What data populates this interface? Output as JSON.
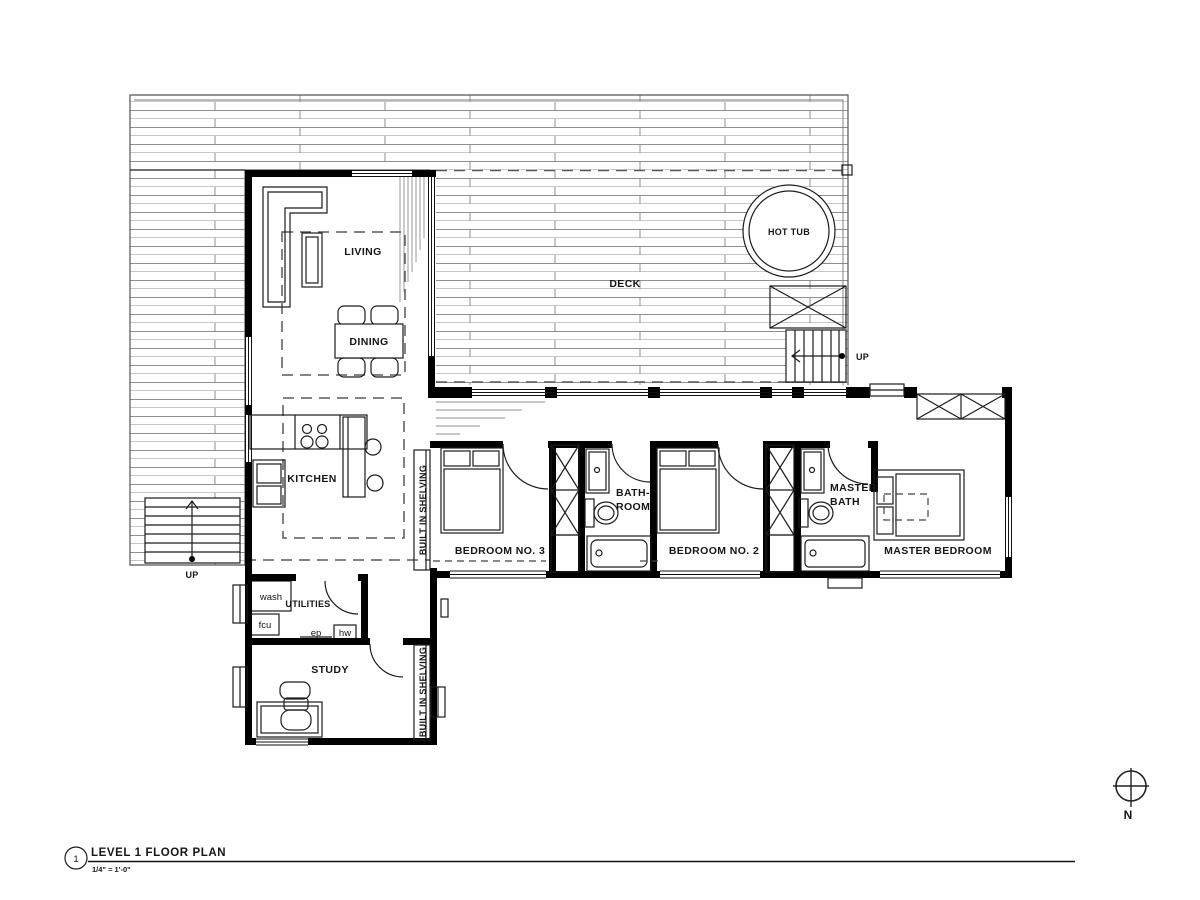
{
  "colors": {
    "background": "#ffffff",
    "wall": "#000000",
    "line": "#1c1c1c",
    "plank": "#8f8f8f",
    "dash": "#5a5a5a"
  },
  "title_block": {
    "detail_number": "1",
    "title": "LEVEL 1 FLOOR PLAN",
    "scale": "1/4\" = 1'-0\""
  },
  "compass": {
    "north": "N"
  },
  "rooms": {
    "deck": {
      "label": "DECK"
    },
    "hot_tub": {
      "label": "HOT TUB"
    },
    "living": {
      "label": "LIVING"
    },
    "dining": {
      "label": "DINING"
    },
    "kitchen": {
      "label": "KITCHEN"
    },
    "utilities": {
      "label": "UTILITIES"
    },
    "study": {
      "label": "STUDY"
    },
    "bedroom3": {
      "label": "BEDROOM NO. 3"
    },
    "bedroom2": {
      "label": "BEDROOM NO. 2"
    },
    "master_bedroom": {
      "label": "MASTER BEDROOM"
    },
    "bathroom": {
      "label_line1": "BATH-",
      "label_line2": "ROOM"
    },
    "master_bath": {
      "label_line1": "MASTER",
      "label_line2": "BATH"
    }
  },
  "equipment": {
    "washer": "wash",
    "fan_coil_unit": "fcu",
    "electrical_panel": "ep",
    "hot_water": "hw"
  },
  "millwork": {
    "shelving_hall": "BUILT IN SHELVING",
    "shelving_study": "BUILT IN SHELVING"
  },
  "stairs": {
    "interior_up": "UP",
    "deck_up": "UP"
  }
}
